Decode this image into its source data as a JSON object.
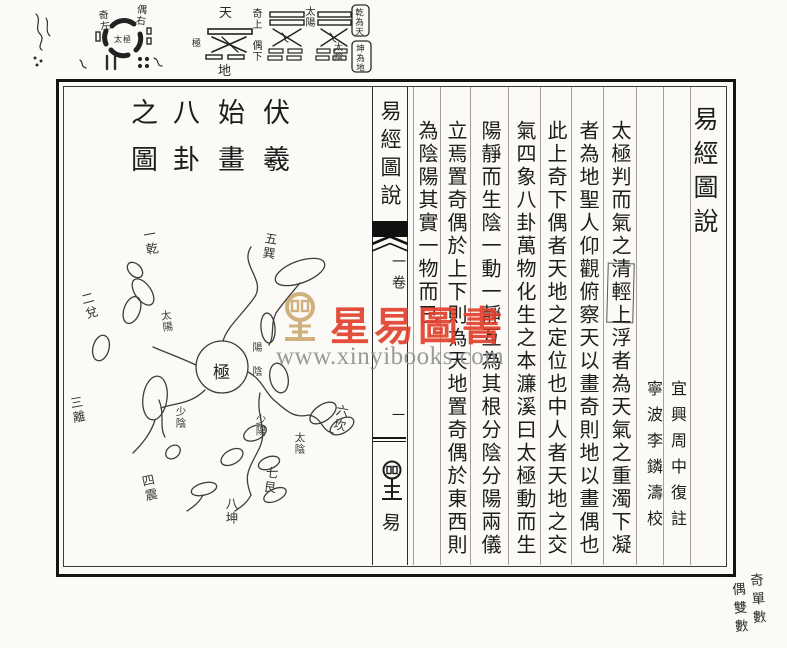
{
  "palette": {
    "ink": "#1d1d1d",
    "red": "#e2412d",
    "gold": "#c9a468",
    "gray": "#8f8f8f"
  },
  "top_margin": {
    "taiji": {
      "center": "太極",
      "left": "奇左",
      "right": "偶右"
    },
    "cross": {
      "top": "天",
      "bottom": "地",
      "left": "極",
      "right_top": "奇上",
      "right_bottom": "偶下"
    },
    "sixiang": {
      "label_a": "太陽",
      "label_b": "太陰",
      "box_top": "乾為天",
      "box_bottom": "坤為地"
    }
  },
  "spine": {
    "title": "易經圖說",
    "volume": "一卷",
    "page_no": "一",
    "bottom_char": "易"
  },
  "right_page": {
    "title": "易經圖說",
    "annotator_1": "宜興周中復註",
    "annotator_2": "寧波李鏻濤校",
    "columns": [
      "太極判而氣之清輕上浮者為天氣之重濁下凝",
      "者為地聖人仰觀俯察天以畫奇則地以畫偶也",
      "此上奇下偶者天地之定位也中人者天地之交",
      "氣四象八卦萬物化生之本濂溪曰太極動而生",
      "陽靜而生陰一動一靜互為其根分陰分陽兩儀",
      "立焉置奇偶於上下則為天地置奇偶於東西則",
      "為陰陽其實一物而已"
    ]
  },
  "left_page": {
    "title_cols": [
      "伏羲",
      "始畫",
      "八卦",
      "之圖"
    ],
    "diagram_center": "極",
    "diagram_labels": [
      "一乾",
      "二兌",
      "三離",
      "四震",
      "五巽",
      "六坎",
      "七艮",
      "八坤",
      "太陽",
      "少陰",
      "少陽",
      "太陰",
      "陽",
      "陰"
    ]
  },
  "watermark": {
    "text": "星易圖書",
    "url": "www.xinyibooks.com"
  },
  "bottom_note": {
    "col_right": "奇單數",
    "col_left": "偶雙數"
  }
}
